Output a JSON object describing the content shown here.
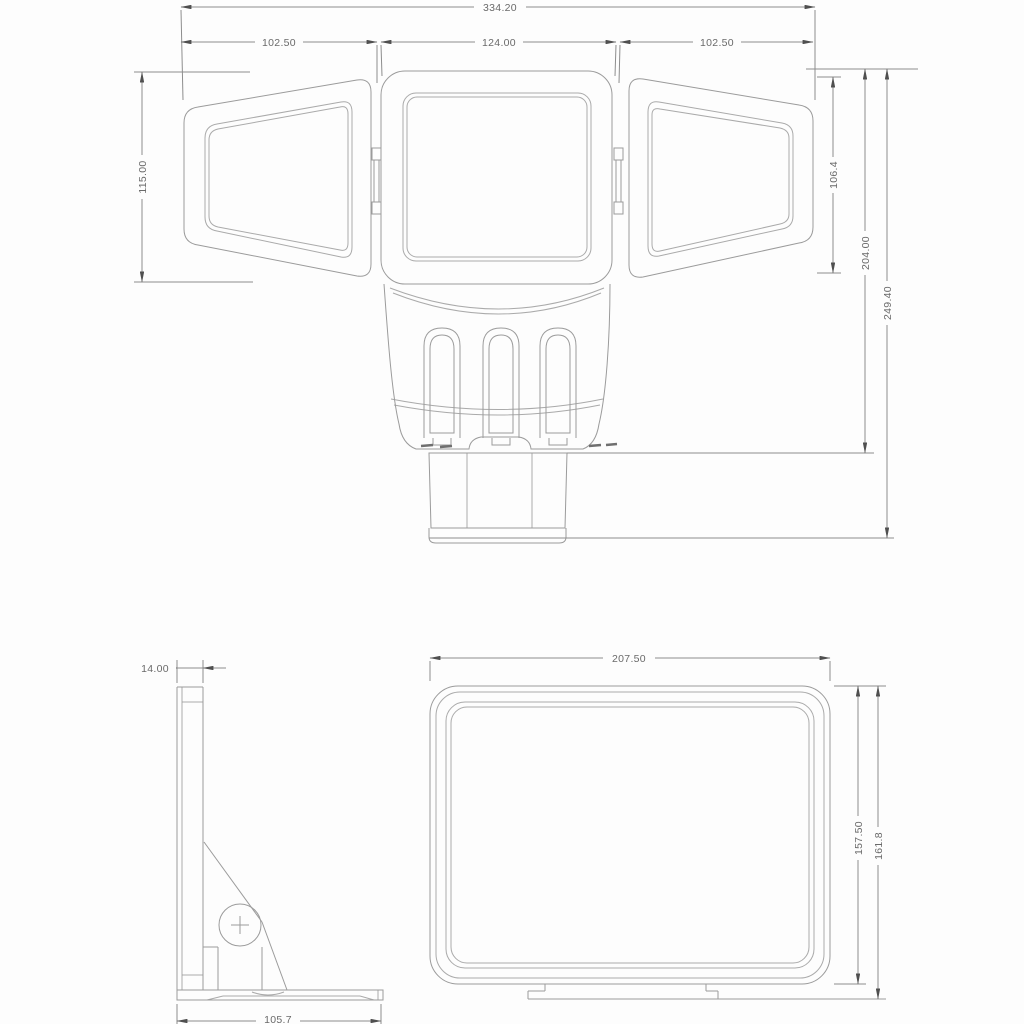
{
  "colors": {
    "background": "#fdfdfd",
    "line": "#9b9b9b",
    "dimension_line": "#8d8d8d",
    "text": "#6a6a6a",
    "arrow": "#4f4f4f"
  },
  "front_view": {
    "overall_width": "334.20",
    "left_head_width": "102.50",
    "center_head_width": "124.00",
    "right_head_width": "102.50",
    "left_head_height": "115.00",
    "right_head_height": "106.4",
    "body_height": "204.00",
    "overall_height": "249.40"
  },
  "side_view": {
    "plate_thickness": "14.00",
    "base_depth": "105.7"
  },
  "bottom_view": {
    "head_width": "207.50",
    "head_height": "157.50",
    "head_height_with_bracket": "161.8"
  }
}
